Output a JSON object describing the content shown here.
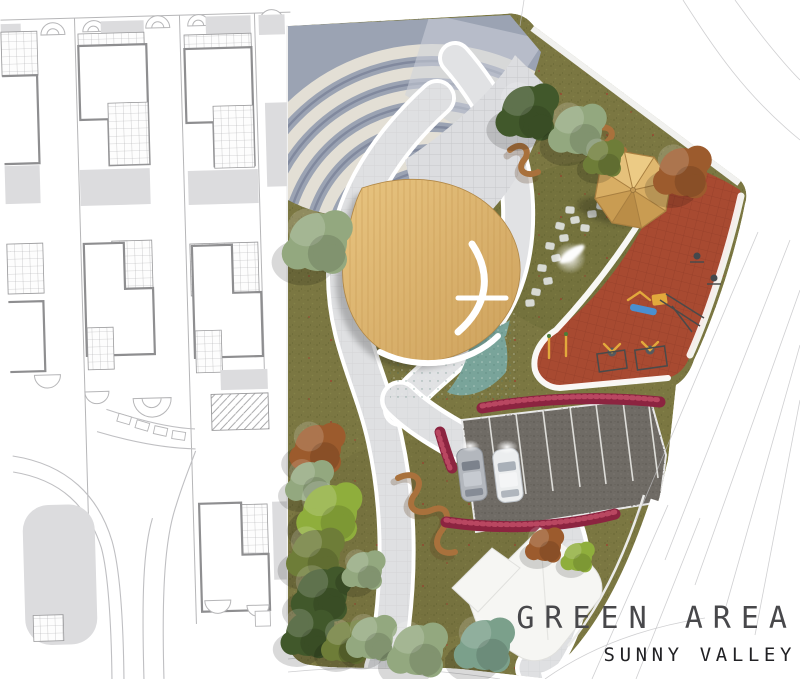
{
  "title": {
    "main": "GREEN AREA",
    "sub": "SUNNY VALLEY"
  },
  "palette": {
    "bg": "#ffffff",
    "plan_line": "#b6b6b8",
    "plan_dark": "#8e8e90",
    "plan_fill": "#dcdcde",
    "road_line": "#bfbfc2",
    "wall": "#fafafa",
    "grass": "#7b7742",
    "grass_dot_dark": "#62622f",
    "grass_dot_light": "#8e8b4d",
    "path": "#e1e2e4",
    "paver_line": "#c8c9cc",
    "white_edge": "#ffffff",
    "amp_base": "#9ba3b3",
    "amp_step": "#e3dfd5",
    "amp_shadow": "#6f7890",
    "wood": "#dcb26c",
    "wood_grain": "#c3954f",
    "water": "#79a49a",
    "red": "#a84a31",
    "red_line": "#8f3b26",
    "hedge": "#8c2440",
    "hedge_light": "#c14e67",
    "asphalt": "#6f6b65",
    "car_silver": "#b3b7bd",
    "car_white": "#eceeef",
    "equip_yellow": "#e2a93c",
    "equip_blue": "#4a8fd0",
    "equip_dark": "#4a4a4a",
    "bench_wood": "#a9713c",
    "stone": "#d8dad3",
    "tree_dark": "#41582b",
    "tree_olive": "#6e7d38",
    "tree_sage": "#93a87f",
    "tree_autumn": "#9c5b2d",
    "tree_chartreuse": "#8fae3c",
    "tree_teal": "#7ba08b",
    "title_main": "#48484b",
    "title_sub": "#222225"
  },
  "park": {
    "counts": {
      "amphitheater_steps": 7,
      "gazebo_roof_segments": 8,
      "parking_stalls": 7,
      "cars": 2,
      "stepping_stones": 13
    },
    "features": [
      "amphitheater",
      "wooden-deck",
      "water-feature",
      "gazebo",
      "fitness-playground",
      "stepping-stones",
      "serpentine-benches",
      "parking-lot",
      "flower-hedges",
      "tree-clusters",
      "lawn",
      "paver-paths"
    ]
  },
  "context": {
    "left_area": "residential-site-plan",
    "right_area": "street-network"
  }
}
